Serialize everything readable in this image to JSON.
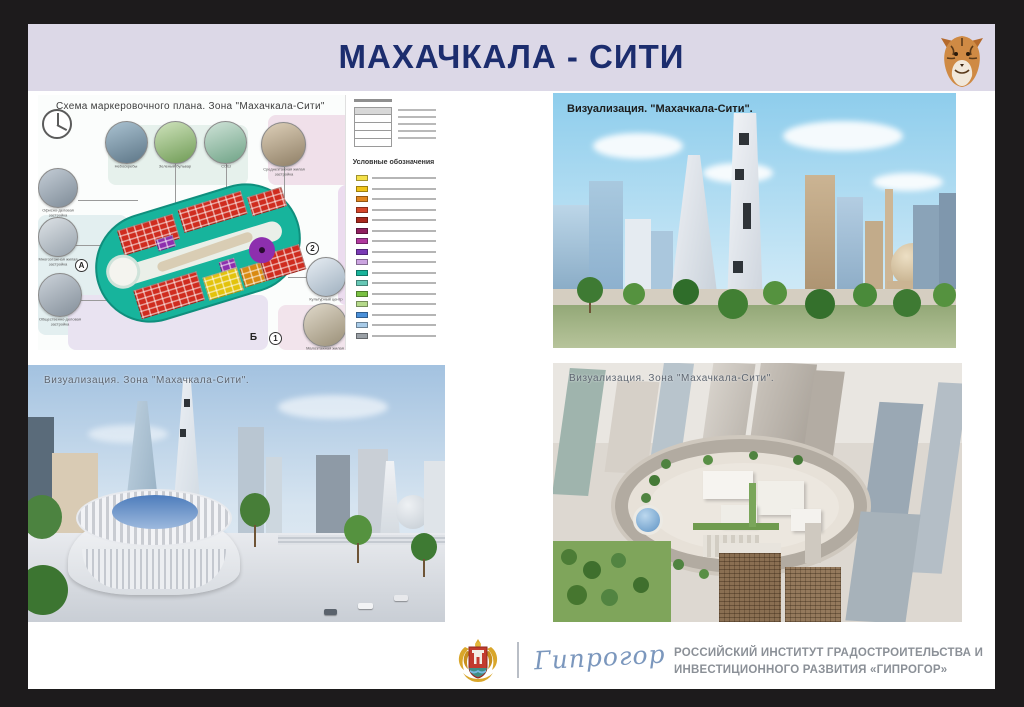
{
  "slide": {
    "title": "МАХАЧКАЛА - СИТИ"
  },
  "colors": {
    "header_band": "#dcd8e7",
    "title_navy": "#1c2d6e",
    "site_teal": "#17b49c",
    "building_red": "#cf2c1f",
    "building_purple": "#8d2fae",
    "building_yellow": "#e3c30d",
    "building_orange": "#d98a12",
    "logo_blue": "#7b97bd"
  },
  "panels": {
    "scheme": {
      "title": "Схема маркеровочного плана. Зона \"Махачкала-Сити\"",
      "legend_title": "Условные обозначения",
      "legend_colors": [
        "#f5e14a",
        "#f0c419",
        "#e0851f",
        "#d4452a",
        "#a8281d",
        "#8f1f5f",
        "#b03a9e",
        "#7a3bb5",
        "#cba4e0",
        "#18b39a",
        "#66c7b5",
        "#7ac143",
        "#b5d98a",
        "#4a90d9",
        "#a8cbe8",
        "#9aa0a6"
      ],
      "callouts_top": [
        {
          "label": "Небоскребы"
        },
        {
          "label": "Зеленый бульвар"
        },
        {
          "label": "СОШ"
        },
        {
          "label": "Среднеэтажная жилая застройка"
        }
      ],
      "callouts_left": [
        {
          "label": "Офисно-деловая застройка"
        },
        {
          "label": "Многоэтажная жилая застройка"
        },
        {
          "label": "Общественно-деловая застройка"
        }
      ],
      "callouts_right": [
        {
          "label": "Культурный центр"
        },
        {
          "label": "Малоэтажная жилая застройка"
        }
      ],
      "markers": [
        "А",
        "2",
        "Б",
        "1"
      ]
    },
    "viz_main": {
      "title": "Визуализация. \"Махачкала-Сити\"."
    },
    "viz_zone_left": {
      "title": "Визуализация. Зона \"Махачкала-Сити\"."
    },
    "viz_zone_right": {
      "title": "Визуализация. Зона \"Махачкала-Сити\"."
    }
  },
  "footer": {
    "logo_script": "Гипрогор",
    "org_line1": "РОССИЙСКИЙ ИНСТИТУТ ГРАДОСТРОИТЕЛЬСТВА И",
    "org_line2": "ИНВЕСТИЦИОННОГО РАЗВИТИЯ «ГИПРОГОР»"
  }
}
